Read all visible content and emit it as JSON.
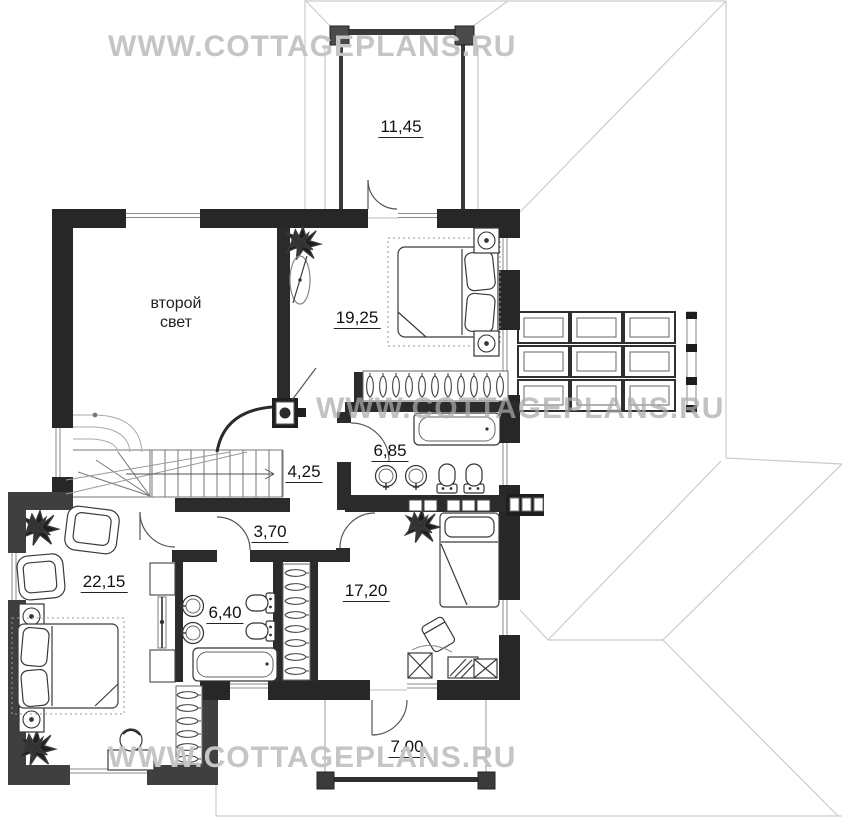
{
  "watermarks": {
    "top": "WWW.COTTAGEPLANS.RU",
    "middle": "WWW.COTTAGEPLANS.RU",
    "bottom": "WWW.COTTAGEPLANS.RU"
  },
  "rooms": {
    "balcony_top": {
      "area": "11,45"
    },
    "second_light": {
      "line1": "второй",
      "line2": "свет"
    },
    "bedroom_top": {
      "area": "19,25"
    },
    "bathroom_top": {
      "area": "6,85"
    },
    "hall": {
      "area": "4,25"
    },
    "corridor": {
      "area": "3,70"
    },
    "bedroom_left": {
      "area": "22,15"
    },
    "bathroom_bottom": {
      "area": "6,40"
    },
    "bedroom_bottom": {
      "area": "17,20"
    },
    "terrace_bottom": {
      "area": "7,00"
    }
  },
  "colors": {
    "wall": "#272727",
    "wing_wall": "#3f3f3f",
    "roof_line": "#cccccc",
    "watermark": "#c5c5c5",
    "label_text": "#111111"
  }
}
